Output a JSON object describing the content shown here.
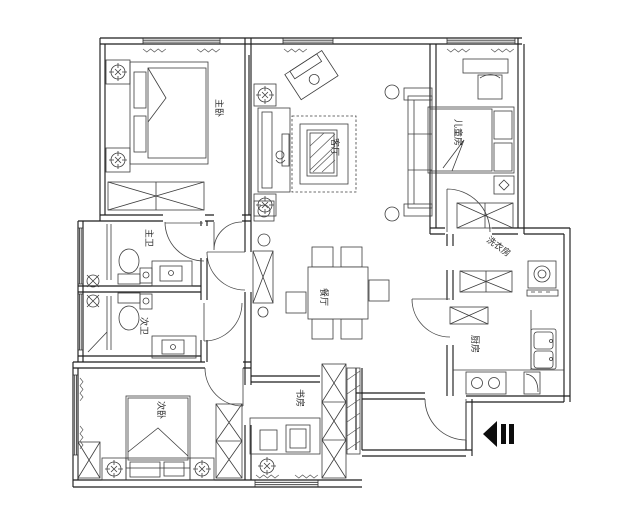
{
  "plan": {
    "type": "apartment-floor-plan",
    "background": "#ffffff",
    "wall_color": "#1e1e1e",
    "furniture_line_color": "#3d3d3d",
    "label_color": "#2e2e2e"
  },
  "rooms": [
    {
      "id": "master-bedroom",
      "label": "主卧"
    },
    {
      "id": "living-room",
      "label": "客厅"
    },
    {
      "id": "kids-room",
      "label": "儿童房"
    },
    {
      "id": "master-bathroom",
      "label": "主卫"
    },
    {
      "id": "second-bathroom",
      "label": "次卫"
    },
    {
      "id": "dining-room",
      "label": "餐厅"
    },
    {
      "id": "laundry-room",
      "label": "洗衣房"
    },
    {
      "id": "kitchen",
      "label": "厨房"
    },
    {
      "id": "second-bedroom",
      "label": "次卧"
    },
    {
      "id": "study",
      "label": "书房"
    }
  ],
  "icons": {
    "entrance": "entrance-arrow-icon"
  }
}
